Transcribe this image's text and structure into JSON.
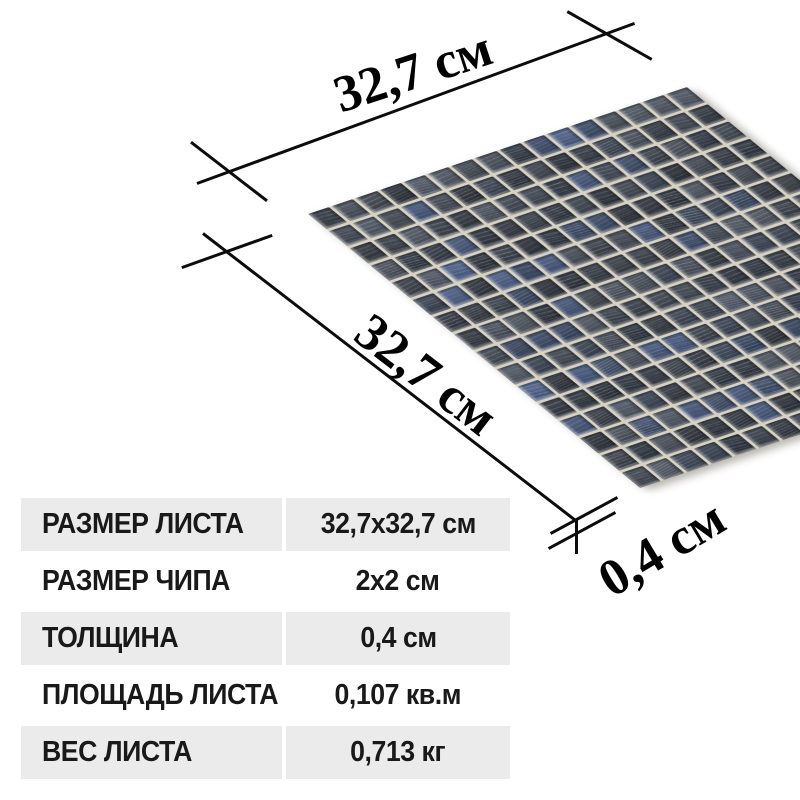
{
  "annotations": {
    "sheet_width_label": "32,7 см",
    "sheet_height_label": "32,7 см",
    "thickness_label": "0,4 см",
    "line_color": "#0c0c0c",
    "label_color": "#000000"
  },
  "mosaic": {
    "grid_size": 16,
    "grout_color": "#d8d2c3",
    "base_tile_colors": [
      "#2c3036",
      "#34383f",
      "#3b4047",
      "#42474f",
      "#4a4f58",
      "#515761",
      "#3a4350",
      "#2f343c"
    ],
    "blue_tile_colors": [
      "#3d4c68",
      "#45577b",
      "#4e6188",
      "#37455f"
    ],
    "streak_light_rgb": "205,215,228",
    "streak_blue_rgb": "96,136,200"
  },
  "spec_table": {
    "rows": [
      {
        "label": "РАЗМЕР ЛИСТА",
        "value": "32,7x32,7 см"
      },
      {
        "label": "РАЗМЕР ЧИПА",
        "value": "2x2 см"
      },
      {
        "label": "ТОЛЩИНА",
        "value": "0,4 см"
      },
      {
        "label": "ПЛОЩАДЬ ЛИСТА",
        "value": "0,107 кв.м"
      },
      {
        "label": "ВЕС ЛИСТА",
        "value": "0,713 кг"
      }
    ],
    "row_background_even": "#ebebeb",
    "row_background_odd": "#ffffff",
    "text_color": "#191919"
  }
}
